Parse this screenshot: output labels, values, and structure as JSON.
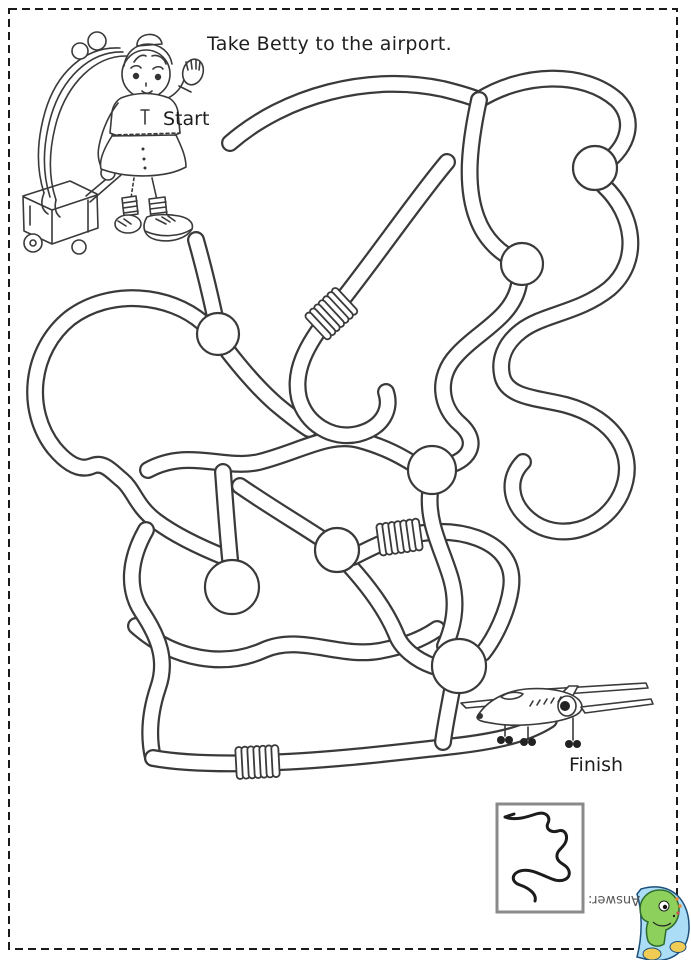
{
  "page": {
    "title": "Take Betty to the airport.",
    "background": "#ffffff",
    "border_color": "#1a1a1a"
  },
  "labels": {
    "start": "Start",
    "finish": "Finish",
    "answer": "Answer:"
  },
  "colors": {
    "maze_line": "#3a3a3a",
    "logo_blue": "#abdef6",
    "logo_green": "#8ed05c",
    "logo_yellow": "#f1cc55",
    "logo_spot_orange": "#e8893a",
    "answer_text": "#555555"
  },
  "illustrations": {
    "girl": "betty-with-rolling-suitcase",
    "airplane": "passenger-jet-at-finish",
    "maze": "tangled-path-maze-with-knots-and-coils",
    "answer_box": "mini-solution-path",
    "logo": "dino-mascot-logo"
  }
}
